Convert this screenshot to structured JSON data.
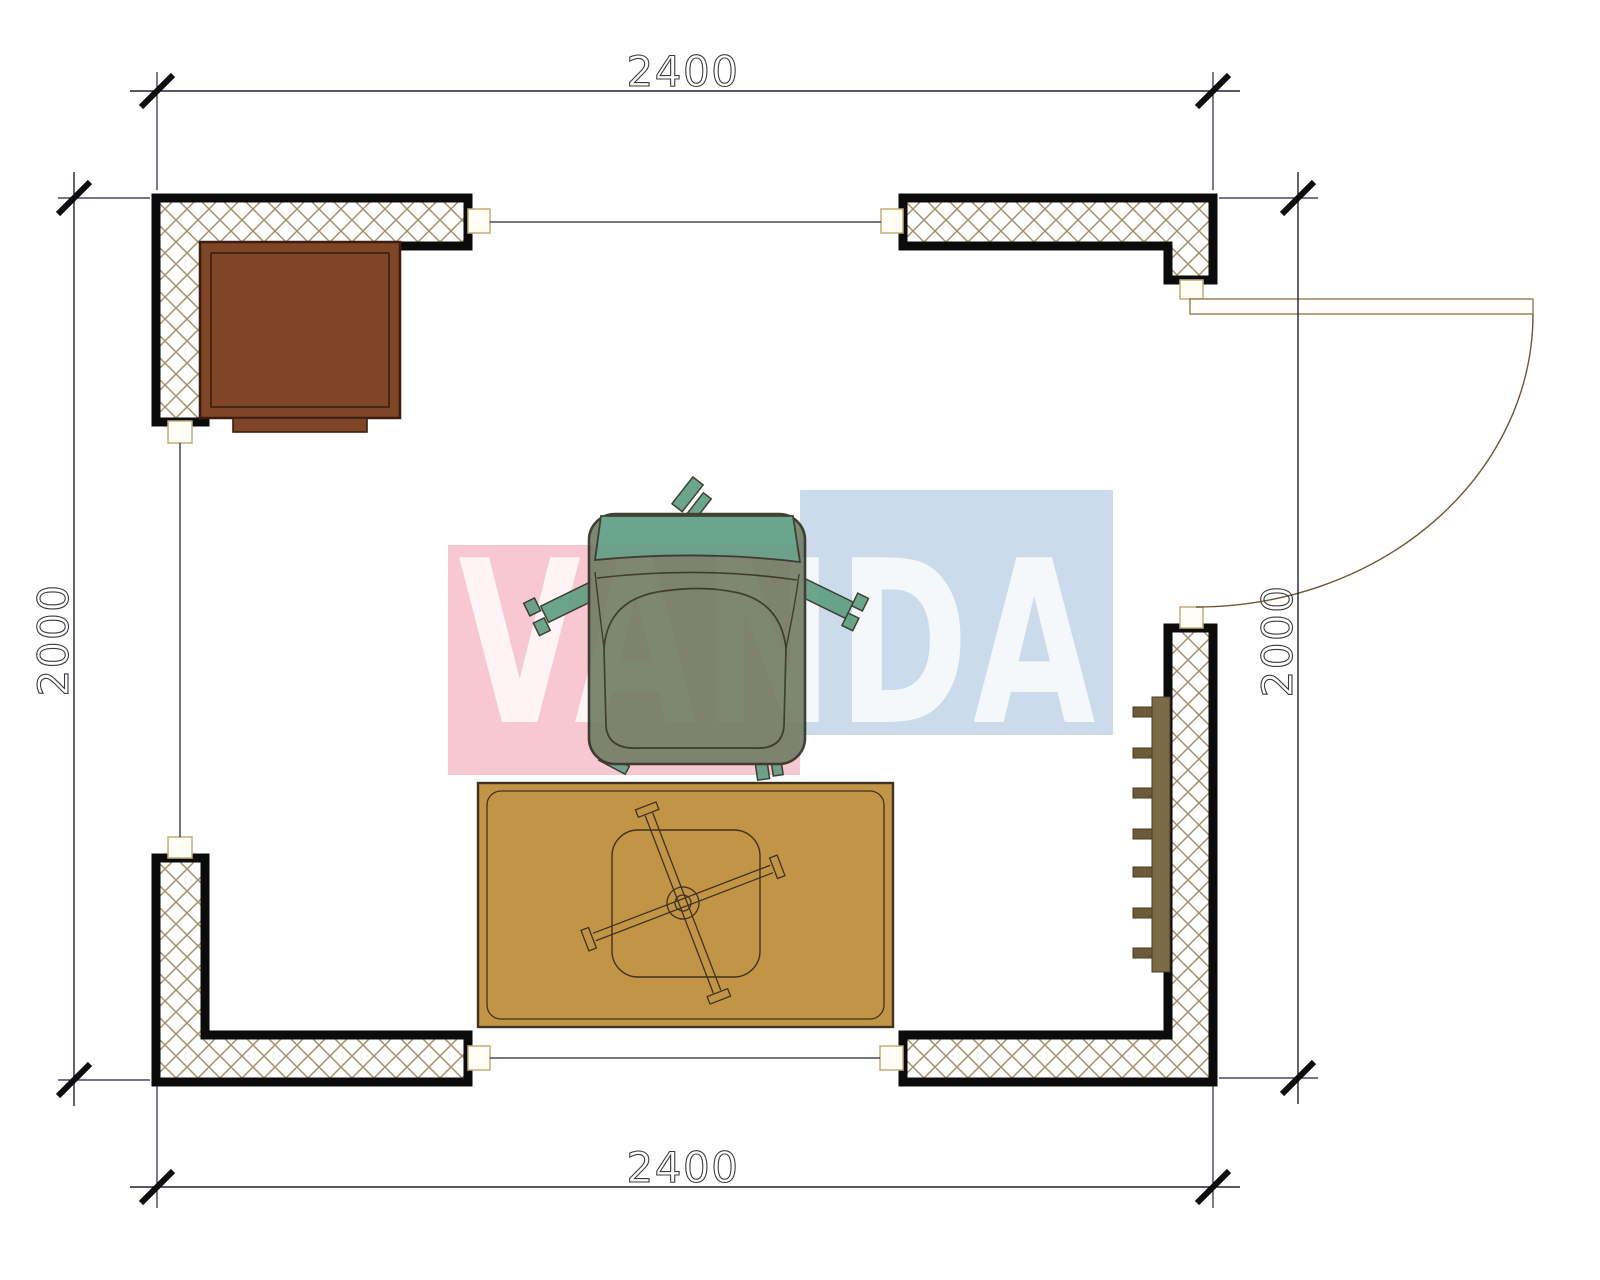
{
  "title": "room-floor-plan",
  "dimensions": {
    "top": "2400",
    "bottom": "2400",
    "left": "2000",
    "right": "2000"
  },
  "watermark": {
    "text": "VANDA",
    "pink": "#F7C8D1",
    "blue": "#CCDBEB",
    "letter": "#FFFFFF"
  },
  "colors": {
    "wall_outline": "#0b0b0b",
    "hatch_line": "#a3906b",
    "cap_fill": "#fffdf4",
    "cap_stroke": "#c2ad7c",
    "opening_line": "#23234e",
    "dim_line": "#20203a",
    "tick": "#0d0d0d",
    "dim_text": "#3b3b3b",
    "door": "#6b5836",
    "cabinet": "#7f4527",
    "cabinet_outline": "#3a1f10",
    "chair_body": "#6f7b64",
    "chair_back": "#5c9b80",
    "chair_outline": "#2b2b1d",
    "table": "#c29445",
    "table_outline": "#3f3320",
    "radiator": "#7a6a45",
    "radiator_fin": "#6b5b3a"
  }
}
